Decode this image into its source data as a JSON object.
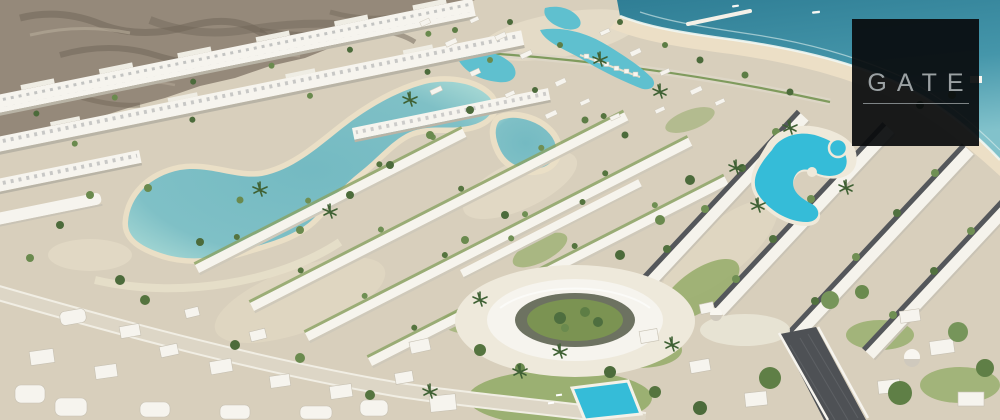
{
  "watermark": {
    "text": "GATE"
  },
  "palette": {
    "sand": "#d8cfbc",
    "beach": "#ecdfc6",
    "ocean_deep": "#2f7e95",
    "ocean_mid": "#4596aa",
    "ocean_shallow": "#82c2cb",
    "surf": "#f2f7f2",
    "lagoon_center": "#74bac2",
    "lagoon_edge": "#a3d6d3",
    "canal": "#5fc0cf",
    "pool": "#35bcd8",
    "mountain": "#95897a",
    "mountain_shadow": "#6e6355",
    "building_white": "#f6f4ee",
    "building_shade": "#c9c3b5",
    "roof_dark": "#54575b",
    "road_light": "#ddd6c6",
    "road_dark": "#4e5155",
    "tree_dark": "#4c6b3b",
    "tree_mid": "#6a8a4e",
    "tree_light": "#8aa263",
    "lawn": "#95ac69",
    "logo_background": "#0a0c0e",
    "logo_text": "#9ba1a3"
  }
}
